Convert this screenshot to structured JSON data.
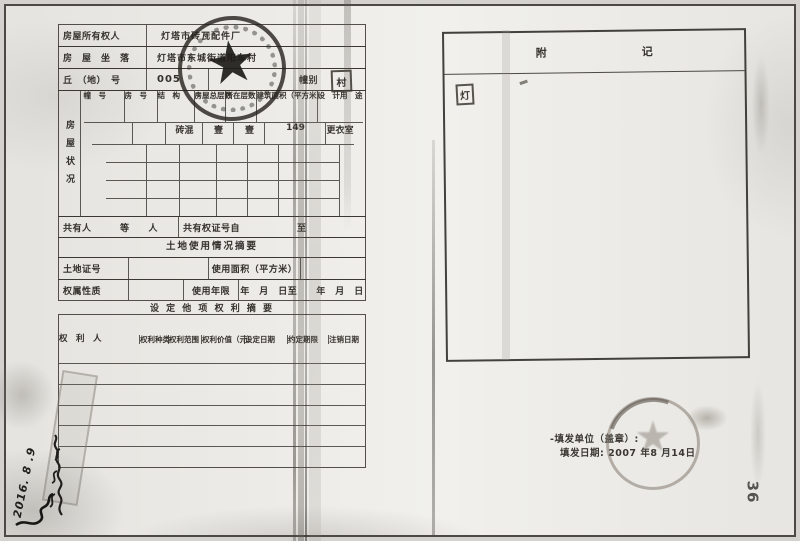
{
  "left_form": {
    "row_owner": {
      "label": "房屋所有权人",
      "value": "灯塔市砖瓦配件厂"
    },
    "row_location": {
      "label": "房　屋　坐　落",
      "value": "灯塔市东城街道阳车村"
    },
    "row_plot": {
      "label": "丘　（地）　号",
      "value": "005",
      "building_label": "幢别",
      "stamp_char": "村"
    },
    "house_table": {
      "side_label": "房屋状况",
      "columns": [
        [
          "幢　号",
          ""
        ],
        [
          "房　号",
          ""
        ],
        [
          "结　构",
          ""
        ],
        [
          "房屋",
          "总层数"
        ],
        [
          "所在",
          "层数"
        ],
        [
          "建筑面积",
          "（平方米）"
        ],
        [
          "设　计",
          "用　途"
        ]
      ],
      "data_row": [
        "",
        "",
        "砖混",
        "壹",
        "壹",
        "149",
        "更衣室"
      ]
    },
    "row_coowner": {
      "left": "共有人　　　等　　人",
      "right": "共有权证号自　　　　　　至"
    },
    "land_title": "土地使用情况摘要",
    "row_land": {
      "cert_label": "土地证号",
      "area_label": "使用面积（平方米）"
    },
    "row_tenure": {
      "nature_label": "权属性质",
      "years_label": "使用年限",
      "dates": "年　月　日至　　年　月　日"
    },
    "rights_title": "设 定 他 项 权 利 摘 要",
    "rights_table": {
      "columns": [
        [
          "权　利　人",
          ""
        ],
        [
          "权利",
          "种类"
        ],
        [
          "权利",
          "范围"
        ],
        [
          "权利价值",
          "（元）"
        ],
        [
          "设定",
          "日期"
        ],
        [
          "约定",
          "期限"
        ],
        [
          "注销",
          "日期"
        ]
      ]
    }
  },
  "right_page": {
    "title_char1": "附",
    "title_char2": "记",
    "corner_stamp_char": "灯",
    "issue_unit": "-填发单位（盖章）:",
    "issue_date": "填发日期: 2007 年8 月14日",
    "page_number": "36"
  },
  "annotations": {
    "handwriting_date": "2016. 8 .9"
  }
}
